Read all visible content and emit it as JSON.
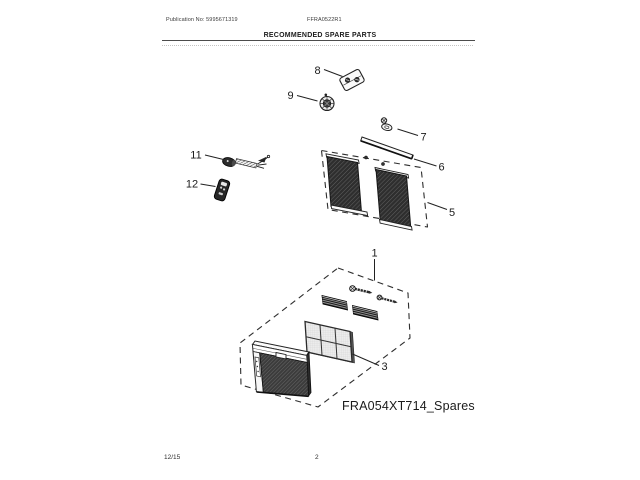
{
  "header": {
    "publication": "Publication No: 5995671319",
    "model": "FFRA0522R1",
    "title": "RECOMMENDED SPARE PARTS"
  },
  "diagram": {
    "label": "FRA054XT714_Spares",
    "callouts": [
      {
        "number": "8",
        "part": "drain-clamp"
      },
      {
        "number": "9",
        "part": "drain-cap"
      },
      {
        "number": "7",
        "part": "screw-with-washer"
      },
      {
        "number": "6",
        "part": "top-seal-rail"
      },
      {
        "number": "5",
        "part": "window-side-curtain-kit"
      },
      {
        "number": "11",
        "part": "power-cord"
      },
      {
        "number": "12",
        "part": "remote-control"
      },
      {
        "number": "1",
        "part": "spares-kit-box"
      },
      {
        "number": "3",
        "part": "air-filter"
      }
    ]
  },
  "footer": {
    "date": "12/15",
    "page_number": "2"
  }
}
